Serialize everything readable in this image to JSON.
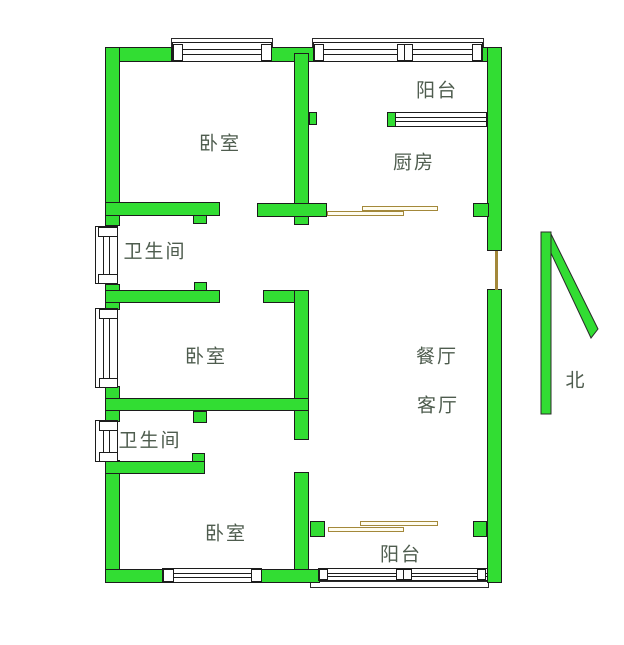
{
  "colors": {
    "wall_green": "#32dd33",
    "outline": "#1c1c1c",
    "door_tan": "#a3883a",
    "label_text": "#4e5c4e",
    "background": "#ffffff"
  },
  "labels": [
    {
      "name": "room-label-bedroom-top",
      "text": "卧室",
      "x": 220,
      "y": 142
    },
    {
      "name": "room-label-balcony-top",
      "text": "阳台",
      "x": 437,
      "y": 89
    },
    {
      "name": "room-label-kitchen",
      "text": "厨房",
      "x": 414,
      "y": 161
    },
    {
      "name": "room-label-bathroom-upper",
      "text": "卫生间",
      "x": 155,
      "y": 250
    },
    {
      "name": "room-label-bedroom-middle",
      "text": "卧室",
      "x": 206,
      "y": 355
    },
    {
      "name": "room-label-dining-room",
      "text": "餐厅",
      "x": 437,
      "y": 355
    },
    {
      "name": "room-label-living-room",
      "text": "客厅",
      "x": 438,
      "y": 404
    },
    {
      "name": "room-label-bathroom-lower",
      "text": "卫生间",
      "x": 150,
      "y": 439
    },
    {
      "name": "room-label-bedroom-bottom",
      "text": "卧室",
      "x": 226,
      "y": 532
    },
    {
      "name": "room-label-balcony-bottom",
      "text": "阳台",
      "x": 401,
      "y": 553
    }
  ],
  "north": {
    "label": "北",
    "x": 576,
    "y": 379,
    "shaft": {
      "x": 11,
      "y": 7,
      "w": 10,
      "h": 182
    },
    "diagonal_points": "12,9 20,7 68,104 61,113"
  },
  "walls": [
    {
      "name": "top-wall-left",
      "r": [
        105,
        47,
        67,
        15
      ]
    },
    {
      "name": "top-wall-middle",
      "r": [
        270,
        47,
        46,
        15
      ]
    },
    {
      "name": "top-wall-right-corner",
      "r": [
        481,
        47,
        21,
        15
      ]
    },
    {
      "name": "left-wall-upper",
      "r": [
        105,
        47,
        15,
        179
      ]
    },
    {
      "name": "left-wall-mid-1",
      "r": [
        105,
        284,
        15,
        26
      ]
    },
    {
      "name": "left-wall-mid-2",
      "r": [
        105,
        386,
        15,
        36
      ]
    },
    {
      "name": "left-wall-lower",
      "r": [
        105,
        460,
        15,
        123
      ]
    },
    {
      "name": "right-wall-upper",
      "r": [
        487,
        47,
        15,
        204
      ]
    },
    {
      "name": "right-wall-lower",
      "r": [
        487,
        289,
        15,
        294
      ]
    },
    {
      "name": "bedroom-kitchen-divider",
      "r": [
        294,
        53,
        15,
        153
      ]
    },
    {
      "name": "divider-window-stub",
      "r": [
        309,
        112,
        8,
        13
      ]
    },
    {
      "name": "kitchen-bottom-wall-left",
      "r": [
        257,
        203,
        70,
        14
      ]
    },
    {
      "name": "kitchen-bottom-wall-right",
      "r": [
        473,
        203,
        16,
        14
      ]
    },
    {
      "name": "bedroom-top-bottom-wall",
      "r": [
        105,
        202,
        115,
        14
      ]
    },
    {
      "name": "door-jamb-bedroom-top",
      "r": [
        193,
        215,
        14,
        9
      ]
    },
    {
      "name": "door-jamb-divider-foot",
      "r": [
        294,
        216,
        15,
        9
      ]
    },
    {
      "name": "bathroom-upper-bottom-wall",
      "r": [
        105,
        290,
        115,
        13
      ]
    },
    {
      "name": "door-jamb-bathroom-upper",
      "r": [
        194,
        282,
        13,
        9
      ]
    },
    {
      "name": "hall-wall-stub",
      "r": [
        263,
        290,
        46,
        13
      ]
    },
    {
      "name": "central-vertical-wall",
      "r": [
        294,
        290,
        15,
        150
      ]
    },
    {
      "name": "bedroom-middle-bottom-wall",
      "r": [
        105,
        398,
        204,
        13
      ]
    },
    {
      "name": "door-jamb-bedroom-middle",
      "r": [
        193,
        411,
        14,
        12
      ]
    },
    {
      "name": "bathroom-lower-bottom-wall",
      "r": [
        105,
        461,
        100,
        13
      ]
    },
    {
      "name": "door-jamb-bathroom-lower",
      "r": [
        192,
        453,
        13,
        9
      ]
    },
    {
      "name": "bedroom-bottom-right-wall",
      "r": [
        294,
        472,
        15,
        101
      ]
    },
    {
      "name": "bottom-wall-left",
      "r": [
        105,
        569,
        58,
        14
      ]
    },
    {
      "name": "bottom-wall-middle",
      "r": [
        260,
        569,
        60,
        14
      ]
    },
    {
      "name": "balcony-door-post-left",
      "r": [
        310,
        521,
        15,
        16
      ]
    },
    {
      "name": "balcony-door-post-right",
      "r": [
        473,
        521,
        14,
        16
      ]
    },
    {
      "name": "kitchen-window-post",
      "r": [
        387,
        112,
        10,
        15
      ]
    }
  ],
  "sills": [
    {
      "name": "window-sill-bedroom-top",
      "r": [
        171,
        38,
        102,
        10
      ]
    },
    {
      "name": "window-sill-balcony-top",
      "r": [
        312,
        38,
        172,
        10
      ]
    },
    {
      "name": "window-sill-balcony-bottom",
      "r": [
        310,
        581,
        179,
        7
      ]
    }
  ],
  "windows_h": [
    {
      "name": "window-bedroom-top",
      "r": [
        172,
        42,
        100,
        20
      ]
    },
    {
      "name": "window-balcony-top",
      "r": [
        313,
        42,
        170,
        20
      ]
    },
    {
      "name": "window-kitchen-balcony",
      "r": [
        395,
        112,
        92,
        15
      ]
    },
    {
      "name": "window-bedroom-bottom",
      "r": [
        162,
        568,
        100,
        15
      ]
    },
    {
      "name": "window-balcony-bottom",
      "r": [
        318,
        568,
        170,
        13
      ]
    }
  ],
  "windows_v": [
    {
      "name": "window-bathroom-upper",
      "r": [
        95,
        226,
        23,
        58
      ]
    },
    {
      "name": "window-bedroom-middle",
      "r": [
        95,
        308,
        23,
        80
      ]
    },
    {
      "name": "window-bathroom-lower",
      "r": [
        95,
        420,
        23,
        42
      ]
    }
  ],
  "posts": [
    {
      "name": "window-post",
      "r": [
        173,
        44,
        10,
        17
      ]
    },
    {
      "name": "window-post",
      "r": [
        261,
        44,
        11,
        17
      ]
    },
    {
      "name": "window-post",
      "r": [
        314,
        44,
        10,
        17
      ]
    },
    {
      "name": "window-post",
      "r": [
        397,
        44,
        8,
        17
      ]
    },
    {
      "name": "window-post",
      "r": [
        404,
        44,
        9,
        17
      ]
    },
    {
      "name": "window-post",
      "r": [
        472,
        44,
        10,
        17
      ]
    },
    {
      "name": "window-post",
      "r": [
        163,
        569,
        11,
        13
      ]
    },
    {
      "name": "window-post",
      "r": [
        251,
        569,
        11,
        13
      ]
    },
    {
      "name": "window-post",
      "r": [
        319,
        569,
        9,
        11
      ]
    },
    {
      "name": "window-post",
      "r": [
        396,
        569,
        8,
        11
      ]
    },
    {
      "name": "window-post",
      "r": [
        403,
        569,
        9,
        11
      ]
    },
    {
      "name": "window-post",
      "r": [
        477,
        569,
        9,
        11
      ]
    },
    {
      "name": "window-post",
      "r": [
        98,
        227,
        20,
        10
      ]
    },
    {
      "name": "window-post",
      "r": [
        98,
        274,
        20,
        10
      ]
    },
    {
      "name": "window-post",
      "r": [
        99,
        309,
        19,
        10
      ]
    },
    {
      "name": "window-post",
      "r": [
        99,
        378,
        19,
        10
      ]
    },
    {
      "name": "window-post",
      "r": [
        99,
        421,
        19,
        10
      ]
    },
    {
      "name": "window-post",
      "r": [
        99,
        452,
        19,
        10
      ]
    }
  ],
  "sliding_doors": [
    {
      "name": "sliding-door-kitchen-leaf",
      "r": [
        362,
        206,
        76,
        5
      ]
    },
    {
      "name": "sliding-door-kitchen-leaf",
      "r": [
        327,
        211,
        77,
        5
      ]
    },
    {
      "name": "sliding-door-balcony-leaf",
      "r": [
        360,
        521,
        78,
        5
      ]
    },
    {
      "name": "sliding-door-balcony-leaf",
      "r": [
        328,
        527,
        76,
        5
      ]
    }
  ],
  "door_lines": [
    {
      "name": "entry-door-leaf",
      "r": [
        495,
        251,
        3,
        39
      ]
    }
  ]
}
